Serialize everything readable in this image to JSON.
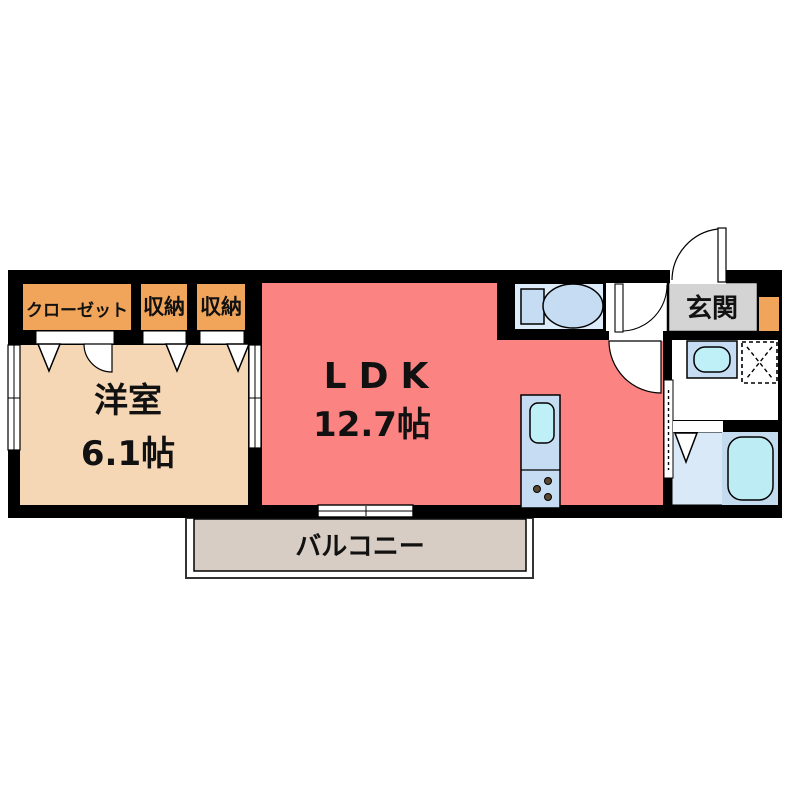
{
  "plan": {
    "rooms": {
      "closet": {
        "label": "クローゼット"
      },
      "storage_a": {
        "label": "収納"
      },
      "storage_b": {
        "label": "収納"
      },
      "western": {
        "name": "洋室",
        "size": "6.1帖"
      },
      "ldk": {
        "name": "LDK",
        "size": "12.7帖"
      },
      "entrance": {
        "label": "玄関"
      },
      "balcony": {
        "label": "バルコニー"
      }
    },
    "colors": {
      "wall": "#000000",
      "ldk": "#FB8381",
      "western": "#F5D7B5",
      "closet": "#F0A55A",
      "entrance": "#D4D4D4",
      "balcony_floor": "#D8CDC4",
      "toilet_floor": "#DDECFA",
      "bath_floor": "#D9E9F8",
      "tub_panel": "#C3DAEF",
      "tub": "#BEECF5",
      "fixture": "#C6DCF2",
      "sink": "#BFEFF7"
    }
  }
}
